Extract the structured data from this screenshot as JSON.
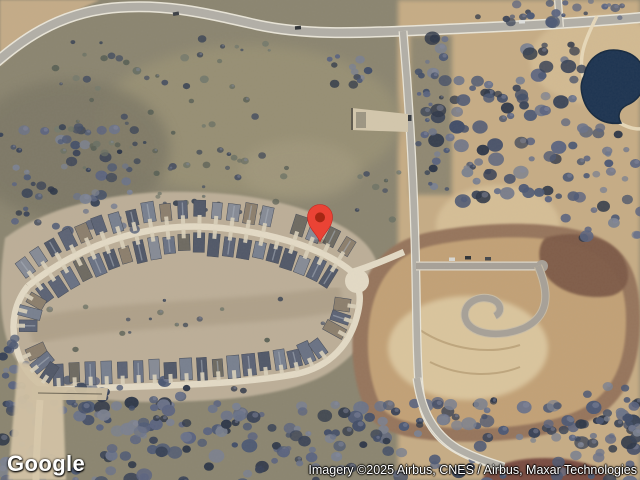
{
  "branding": {
    "logo_text": "Google"
  },
  "attribution": {
    "text": "Imagery ©2025 Airbus, CNES / Airbus, Maxar Technologies"
  },
  "map": {
    "marker": {
      "x": 320,
      "y": 242,
      "color": "#EA4335",
      "dot_color": "#A52714"
    },
    "colors": {
      "field": "#8b8570",
      "sand": "#c9ae86",
      "neighborhood": "#beb09a",
      "dirt_outer": "#96745c",
      "dirt_inner": "#c2a176",
      "dirt_center_sand": "#dac59d",
      "dirt_mound": "#7d5a47",
      "pond": "#1d3451",
      "road": "#b2afa7",
      "road_edge": "#e9e5d8",
      "street": "#e3dac5",
      "driveway": "#d9d0ba",
      "house_palette": [
        "#515868",
        "#5c6375",
        "#6a7284",
        "#78808f",
        "#868b96",
        "#6e6a61",
        "#8c7f6d"
      ],
      "tree_palette": [
        "#2e3748",
        "#384256",
        "#424e68",
        "#4d5974",
        "#5b6480",
        "#6b7389",
        "#7b818f"
      ],
      "scrub_palette": [
        "#5c6257",
        "#6b7164",
        "#4a5261",
        "#757a6c",
        "#3f4856"
      ]
    }
  }
}
